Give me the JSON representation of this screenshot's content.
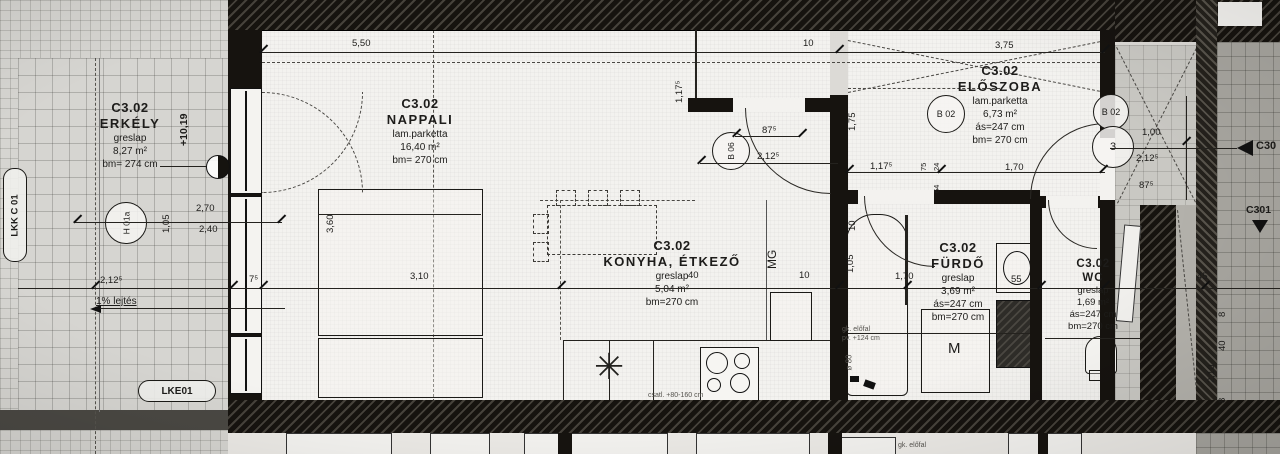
{
  "colors": {
    "ink": "#1d1c1a",
    "paper": "#f3f2ef",
    "balcony": "#d6d5d1",
    "neighbor": "#a7a59f",
    "wall": "#16130f"
  },
  "rooms": [
    {
      "code": "C3.02",
      "name": "ERKÉLY",
      "floor": "greslap",
      "area": "8,27 m²",
      "clear": "bm= 274 cm"
    },
    {
      "code": "C3.02",
      "name": "NAPPALI",
      "floor": "lam.parketta",
      "area": "16,40 m²",
      "clear": "bm= 270 cm"
    },
    {
      "code": "C3.02",
      "name": "KONYHA, ÉTKEZŐ",
      "floor": "greslap",
      "area": "5,04 m²",
      "clear": "bm=270 cm"
    },
    {
      "code": "C3.02",
      "name": "ELŐSZOBA",
      "floor": "lam.parketta",
      "area": "6,73 m²",
      "sus": "ás=247 cm",
      "clear": "bm= 270 cm"
    },
    {
      "code": "C3.02",
      "name": "FÜRDŐ",
      "floor": "greslap",
      "area": "3,69 m²",
      "sus": "ás=247 cm",
      "clear": "bm=270 cm"
    },
    {
      "code": "C3.02",
      "name": "WC",
      "floor": "greslap",
      "area": "1,69 m²",
      "sus": "ás=247 cm",
      "clear": "bm=270 cm"
    }
  ],
  "dims": [
    {
      "t": "5,50"
    },
    {
      "t": "10"
    },
    {
      "t": "3,75"
    },
    {
      "t": "1,17⁵"
    },
    {
      "t": "1,75"
    },
    {
      "t": "87⁵"
    },
    {
      "t": "2,12⁵"
    },
    {
      "t": "1,17⁵"
    },
    {
      "t": "1,70"
    },
    {
      "t": "1,00"
    },
    {
      "t": "2,12⁵"
    },
    {
      "t": "87⁵"
    },
    {
      "t": "2,70"
    },
    {
      "t": "2,40"
    },
    {
      "t": "1,05"
    },
    {
      "t": "3,60"
    },
    {
      "t": "3,10"
    },
    {
      "t": "7⁵"
    },
    {
      "t": "2,12⁵"
    },
    {
      "t": "10"
    },
    {
      "t": "1,05"
    },
    {
      "t": "1,70"
    },
    {
      "t": "10"
    },
    {
      "t": "40"
    },
    {
      "t": "55"
    },
    {
      "t": "45"
    },
    {
      "t": "40"
    },
    {
      "t": "2,10"
    },
    {
      "t": "8"
    },
    {
      "t": "8"
    },
    {
      "t": "75"
    },
    {
      "t": "24"
    },
    {
      "t": "64"
    }
  ],
  "tags": {
    "h01a": "H 01a",
    "b06": "B 06",
    "b02_hall": "B 02",
    "b02_entry": "B 02",
    "entry_no": "3"
  },
  "markers": {
    "level_value": "+10,19",
    "slope": "1% lejtés",
    "lkk": "LKK C 01",
    "lke": "LKE01",
    "c30": "C30",
    "c301": "C301"
  },
  "appliances": {
    "dishwasher": "MG",
    "washer": "M"
  },
  "icons": {
    "sink": "✳"
  },
  "notes": {
    "gk_line1": "gk. előfal",
    "gk_line2": "pv. +124 cm",
    "dia": "ø 80",
    "kitchen_conn": "csatl. +80-160 cm",
    "below": "gk. előfal"
  }
}
